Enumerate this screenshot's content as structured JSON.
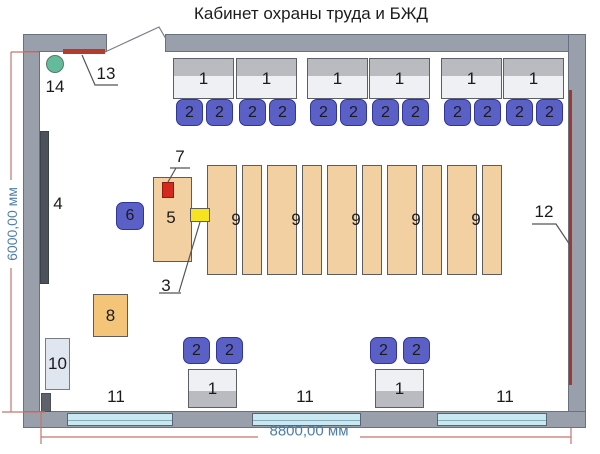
{
  "title": "Кабинет охраны труда и БЖД",
  "dimensions": {
    "width_label": "8800,00 мм",
    "height_label": "6000,00 мм"
  },
  "callouts": {
    "c1": "1",
    "c2": "2",
    "c3": "3",
    "c4": "4",
    "c5": "5",
    "c6": "6",
    "c7": "7",
    "c8": "8",
    "c9": "9",
    "c10": "10",
    "c11": "11",
    "c12": "12",
    "c13": "13",
    "c14": "14"
  }
}
